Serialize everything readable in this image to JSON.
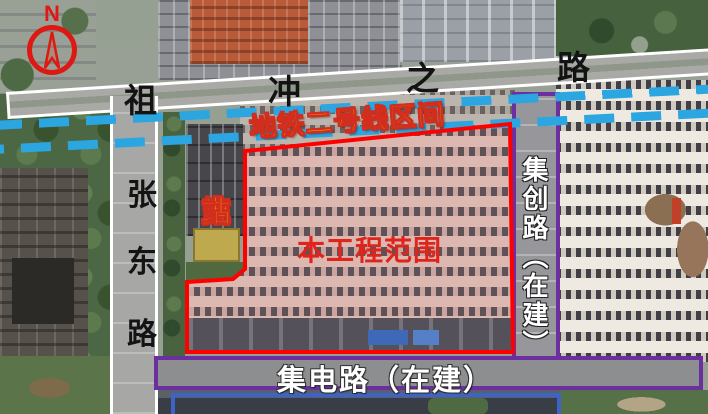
{
  "compass": {
    "north_label": "N"
  },
  "roads": {
    "top": {
      "name": "祖冲之路",
      "chars": [
        "祖",
        "冲",
        "之",
        "路"
      ]
    },
    "left": {
      "name": "张东路",
      "chars": [
        "张",
        "东",
        "路"
      ]
    },
    "right": {
      "name": "集创路（在建）",
      "label": "集创路（在建）",
      "outline_color": "#6B2FA0"
    },
    "bottom": {
      "label": "集电路（在建）",
      "outline_color": "#6B2FA0"
    }
  },
  "metro": {
    "label": "地铁二号线区间",
    "line_color": "#2BA6E0",
    "label_fill_color": "#FFE600",
    "label_outline_color": "#D22E1E",
    "style": "double-dashed-line"
  },
  "project_area": {
    "label": "本工程范围",
    "boundary_color": "#FF0000",
    "label_color": "#DF241C"
  },
  "substation": {
    "label": "变电站",
    "chars": [
      "变",
      "电",
      "站"
    ],
    "text_color": "#FFE600",
    "outline_color": "#D22E1E"
  },
  "under_construction_rect_color": "#3E63C8"
}
